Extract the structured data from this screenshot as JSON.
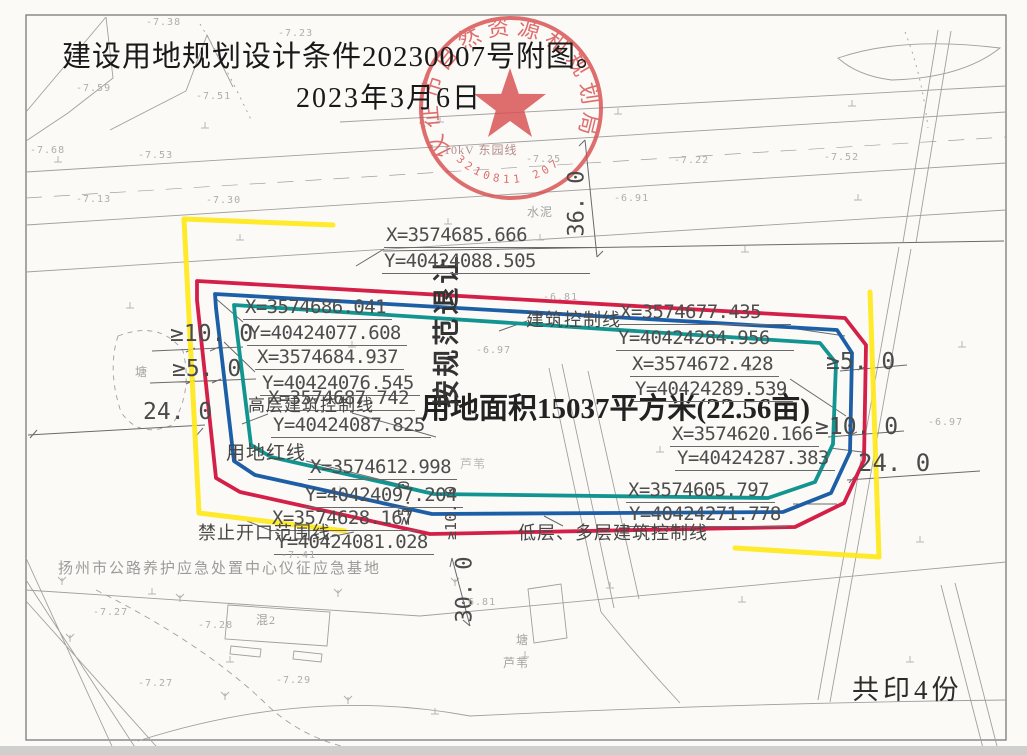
{
  "title": {
    "line1": "建设用地规划设计条件20230007号附图。",
    "line2": "2023年3月6日"
  },
  "print_note": "共印4份",
  "seal": {
    "ring_text": "仪征市自然资源和规划局",
    "serial": "3210811 2070",
    "star_icon": "star"
  },
  "area_label": "用地面积15037平方米(22.56亩)",
  "setback_label": "按规范退让",
  "legend": {
    "red_line": "用地红线",
    "building_control": "建筑控制线",
    "highrise_control": "高层建筑控制线",
    "lowrise_control": "低层、多层建筑控制线",
    "no_opening": "禁止开口范围线"
  },
  "facility_label": "扬州市公路养护应急处置中心仪征应急基地",
  "power_line_label": "10kV 东园线",
  "coords": [
    {
      "x": "X=3574685.666",
      "y": "Y=40424088.505"
    },
    {
      "x": "X=3574686.041",
      "y": "Y=40424077.608"
    },
    {
      "x": "X=3574684.937",
      "y": "Y=40424076.545"
    },
    {
      "x": "X=3574687.742",
      "y": "Y=40424087.825"
    },
    {
      "x": "X=3574612.998",
      "y": "Y=40424097.204"
    },
    {
      "x": "X=3574628.167",
      "y": "Y=40424081.028"
    },
    {
      "x": "X=3574677.435",
      "y": "Y=40424284.956"
    },
    {
      "x": "X=3574672.428",
      "y": "Y=40424289.539"
    },
    {
      "x": "X=3574620.166",
      "y": "Y=40424287.383"
    },
    {
      "x": "X=3574605.797",
      "y": "Y=40424271.778"
    }
  ],
  "dimensions": {
    "left_upper": "≥10. 0",
    "left_lower": "≥5. 0",
    "left_24": "24. 0",
    "right_upper": "≥5. 0",
    "right_lower": "≥10. 0",
    "right_24": "24. 0",
    "road_width": "36. 0",
    "bottom": "30. 0",
    "mid_small_5": "≥5. 0",
    "mid_small_10": "≥10. 0"
  },
  "map_labels": {
    "pond_left": "塘",
    "pond_bottom": "塘",
    "reed_mid": "芦苇",
    "reed_bottom": "芦苇",
    "cement": "水泥",
    "building": "混2"
  },
  "elevations": [
    {
      "v": "-7.38"
    },
    {
      "v": "-7.23"
    },
    {
      "v": "-7.59"
    },
    {
      "v": "-7.51"
    },
    {
      "v": "-7.68"
    },
    {
      "v": "-7.53"
    },
    {
      "v": "-7.52"
    },
    {
      "v": "-7.13"
    },
    {
      "v": "-7.30"
    },
    {
      "v": "-7.25"
    },
    {
      "v": "-7.22"
    },
    {
      "v": "-6.91"
    },
    {
      "v": "-6.81"
    },
    {
      "v": "-6.97"
    },
    {
      "v": "-7.41"
    },
    {
      "v": "-6.81"
    },
    {
      "v": "-7.27"
    },
    {
      "v": "-7.28"
    },
    {
      "v": "-7.29"
    },
    {
      "v": "-7.27"
    },
    {
      "v": "-6.97"
    }
  ],
  "colors": {
    "red_line": "#d42048",
    "blue_line": "#1d5fa6",
    "teal_line": "#129490",
    "yellow_line": "#ffe81a",
    "seal_red": "#d85050",
    "topo_gray": "#9f9f9f"
  }
}
